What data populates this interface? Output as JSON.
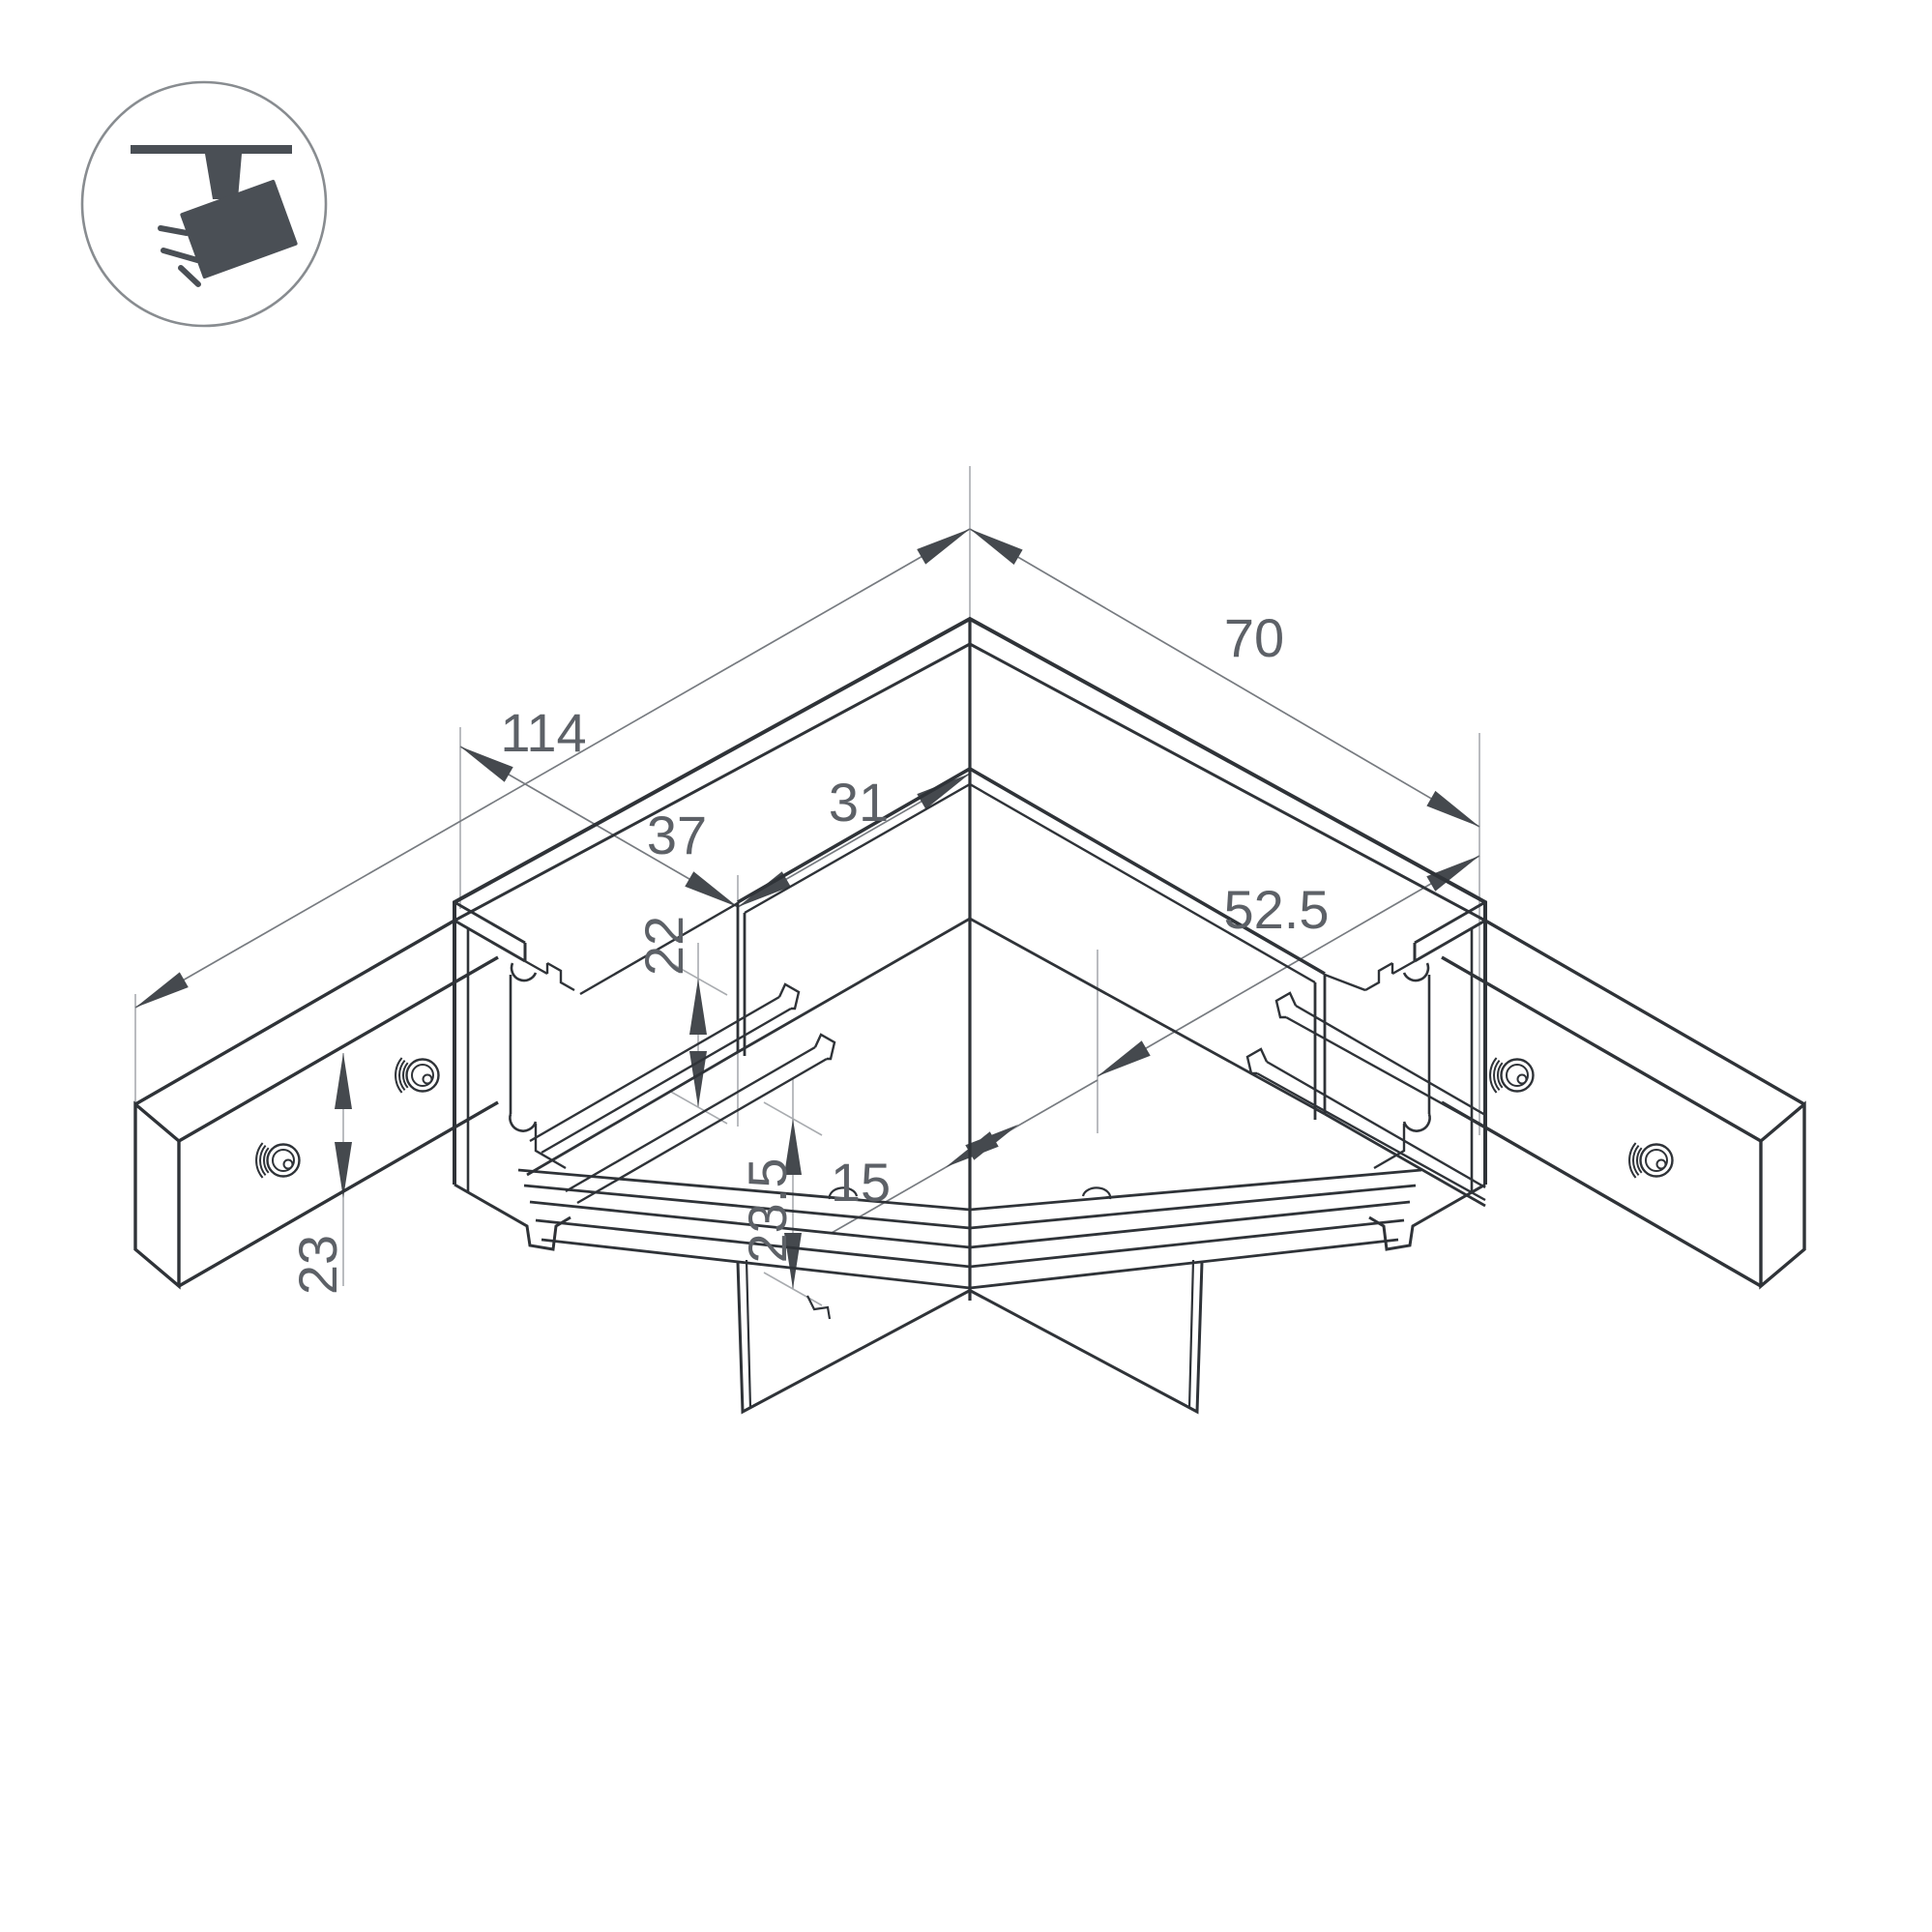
{
  "badge": {
    "icon": "track-spotlight-icon"
  },
  "dims": {
    "d114": "114",
    "d70": "70",
    "d37": "37",
    "d31": "31",
    "d52_5": "52.5",
    "d15": "15",
    "d22": "22",
    "d23_5": "23.5",
    "d23": "23"
  },
  "colors": {
    "line": "#2f3338",
    "dimension_line": "#777b80",
    "extension_line": "#a9acb0",
    "arrow": "#45494e",
    "text": "#5d6167",
    "icon": "#4a4f55",
    "background": "#ffffff"
  }
}
